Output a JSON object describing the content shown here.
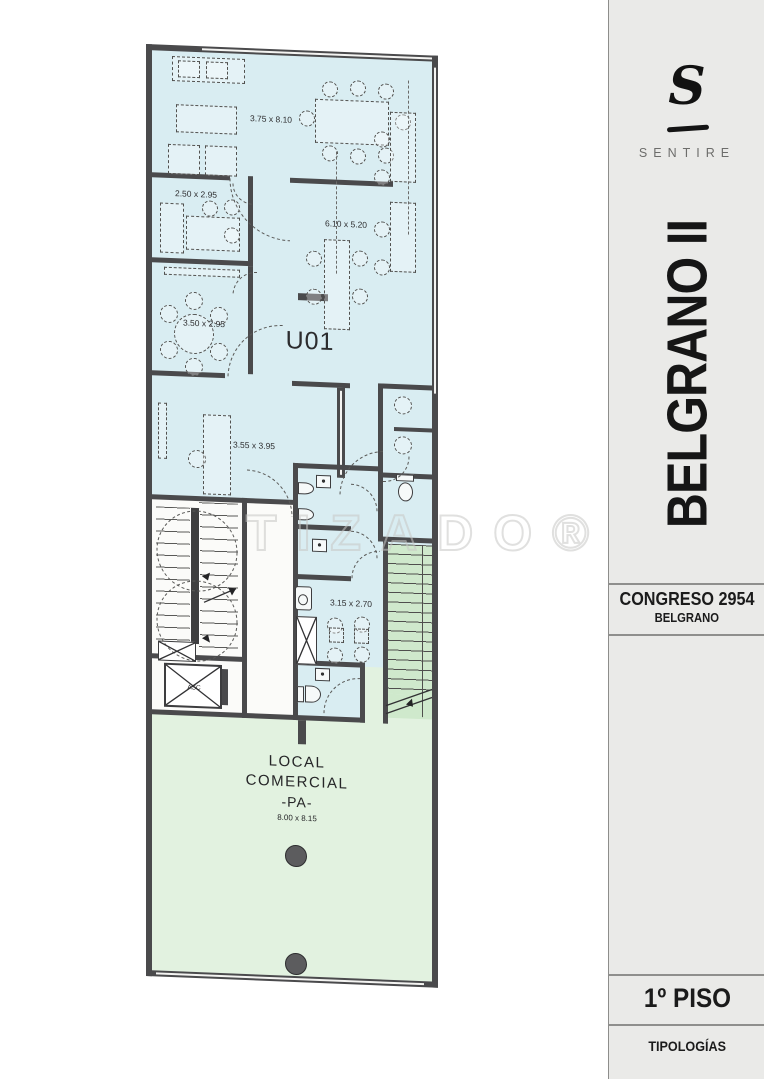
{
  "sidebar": {
    "brand_initial": "S",
    "brand_name": "SENTIRE",
    "project_title": "BELGRANO II",
    "address_line1": "CONGRESO 2954",
    "address_line2": "BELGRANO",
    "floor_label": "1º PISO",
    "footer_label": "TIPOLOGÍAS"
  },
  "plan": {
    "unit_label": "U01",
    "watermark": "TIZADO®",
    "elevator_label": "ASC",
    "commercial": {
      "line1": "LOCAL",
      "line2": "COMERCIAL",
      "line3": "-PA-",
      "dimension": "8.00 x 8.15"
    },
    "dim_labels": [
      {
        "text": "3.75 x 8.10",
        "x": 125,
        "y": 70
      },
      {
        "text": "2.50 x 2.95",
        "x": 50,
        "y": 148
      },
      {
        "text": "6.10 x 5.20",
        "x": 200,
        "y": 172
      },
      {
        "text": "3.50 x 2.95",
        "x": 58,
        "y": 277
      },
      {
        "text": "3.55 x 3.95",
        "x": 108,
        "y": 397
      },
      {
        "text": "3.15 x 2.70",
        "x": 205,
        "y": 551
      }
    ],
    "colors": {
      "office_fill": "#d9edf2",
      "commercial_fill": "#e2f2e0",
      "wall": "#4a4a4c",
      "stair_tread_fill": "#cfe9cc"
    }
  }
}
